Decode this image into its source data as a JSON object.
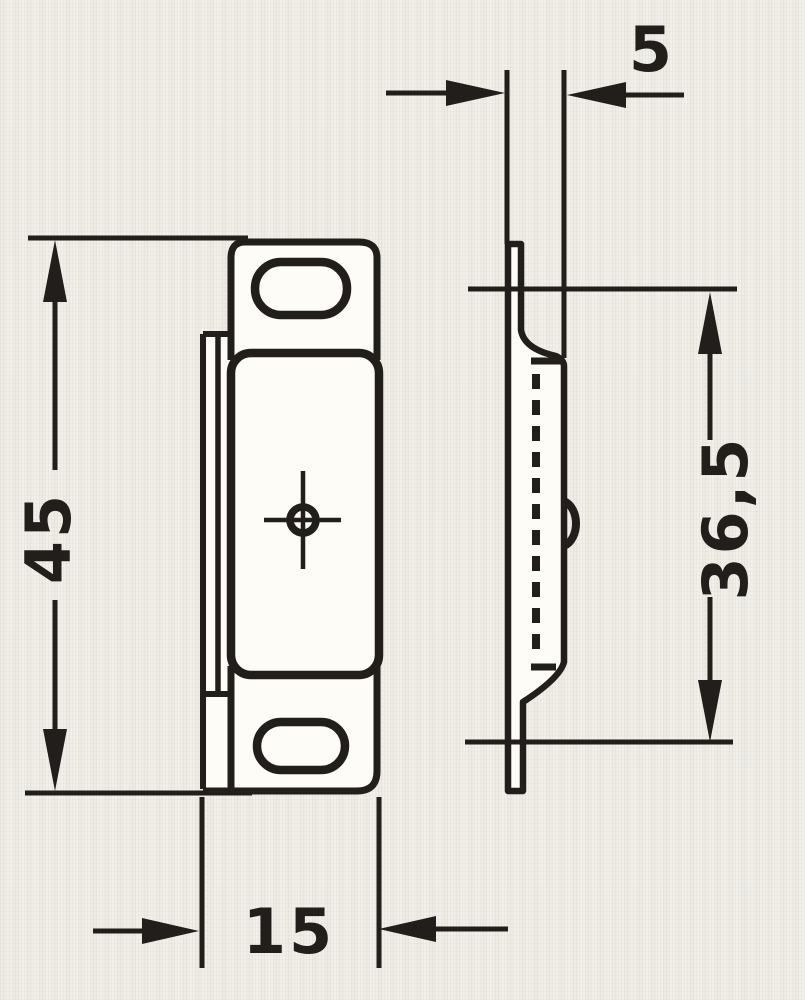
{
  "drawing": {
    "ink_color": "#221e1b",
    "paper_color": "#f1efe9",
    "dimensions": {
      "height": "45",
      "hole_spacing": "36,5",
      "plate_width": "15",
      "depth": "5"
    }
  }
}
